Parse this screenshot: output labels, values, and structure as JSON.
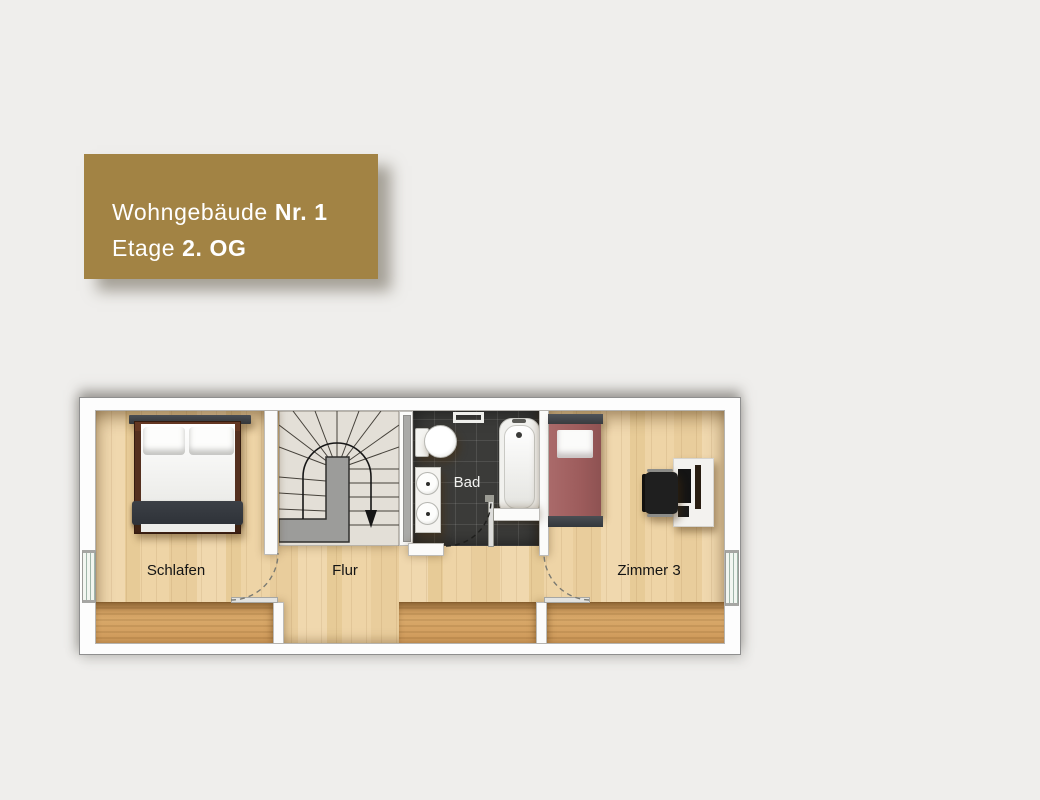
{
  "title_card": {
    "line1": {
      "regular": "Wohngebäude",
      "bold": "Nr. 1"
    },
    "line2": {
      "regular": "Etage",
      "bold": "2. OG"
    },
    "background_color": "#a28344",
    "text_color": "#ffffff"
  },
  "floorplan": {
    "rooms": [
      {
        "id": "schlafen",
        "label": "Schlafen"
      },
      {
        "id": "flur",
        "label": "Flur"
      },
      {
        "id": "bad",
        "label": "Bad"
      },
      {
        "id": "zimmer3",
        "label": "Zimmer 3"
      }
    ],
    "furniture": [
      "double-bed",
      "winder-staircase",
      "toilet",
      "double-sink-vanity",
      "bathtub",
      "single-bed",
      "office-chair",
      "desk"
    ],
    "colors": {
      "wall": "#fbfbfa",
      "parquet_floor": "#ecd2a2",
      "knee_wall_band": "#d2a063",
      "bath_tile": "#3b3b39",
      "stair_tread": "#e3dfd7",
      "stair_core": "#9c9c9a",
      "double_bed_blanket": "#34383e",
      "single_bed_mattress": "#9d5c5c",
      "window_glass": "#9fb5a9"
    }
  },
  "page": {
    "background_color": "#efeeec"
  }
}
